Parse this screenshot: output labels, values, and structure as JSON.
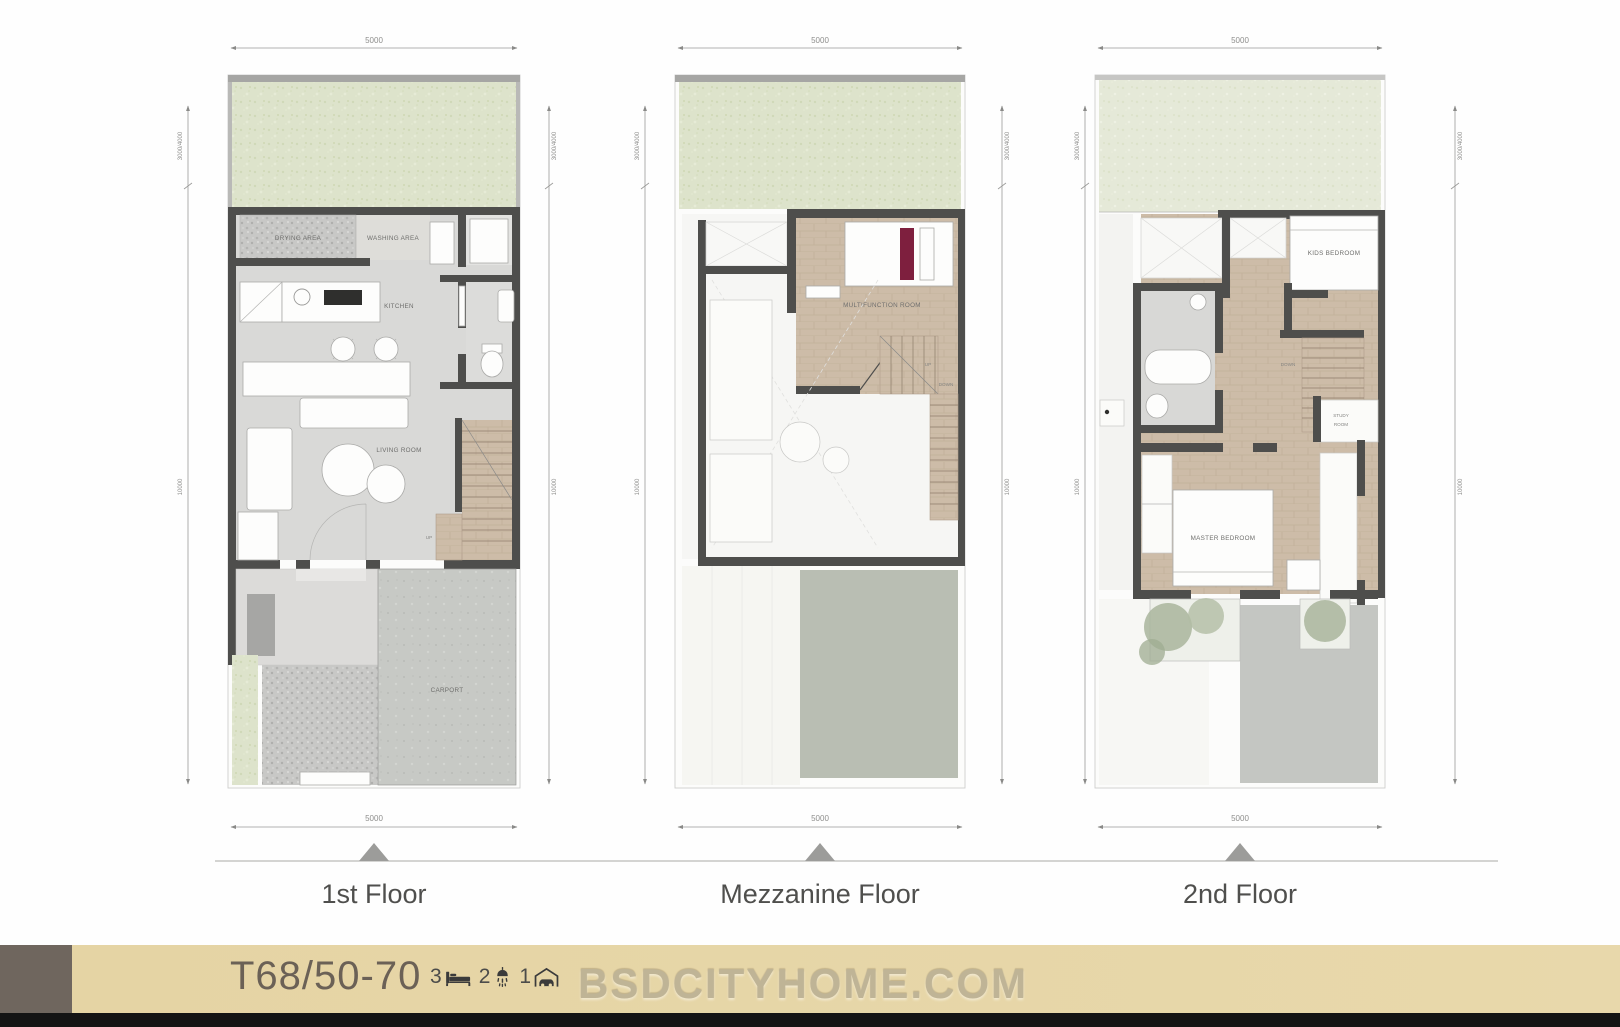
{
  "title": "T68/50-70 townhouse floor plans",
  "dims": {
    "width": "5000",
    "garden_depth": "3000/4000",
    "main_depth": "10000"
  },
  "floors": {
    "first": {
      "label": "1st Floor",
      "rooms": {
        "drying": "DRYING AREA",
        "washing": "WASHING AREA",
        "kitchen": "KITCHEN",
        "living": "LIVING ROOM",
        "carport": "CARPORT"
      },
      "stairs": {
        "up": "UP"
      }
    },
    "mezzanine": {
      "label": "Mezzanine Floor",
      "rooms": {
        "multifunction": "MULTIFUNCTION ROOM"
      },
      "stairs": {
        "up": "UP",
        "down": "DOWN"
      }
    },
    "second": {
      "label": "2nd Floor",
      "rooms": {
        "kids": "KIDS BEDROOM",
        "study1": "STUDY",
        "study2": "ROOM",
        "master": "MASTER BEDROOM"
      },
      "stairs": {
        "down": "DOWN"
      }
    }
  },
  "banner": {
    "model": "T68/50-70",
    "beds": "3",
    "baths": "2",
    "cars": "1",
    "watermark": "BSDCITYHOME.COM"
  },
  "colors": {
    "wall": "#4e4e4c",
    "garden_green": "#dde3cb",
    "wood_floor": "#cdbca8",
    "pillow_accent": "#7e1f3e",
    "banner_bg": "#e5d4a4",
    "banner_block": "#6f665e",
    "black_bar": "#141414"
  }
}
